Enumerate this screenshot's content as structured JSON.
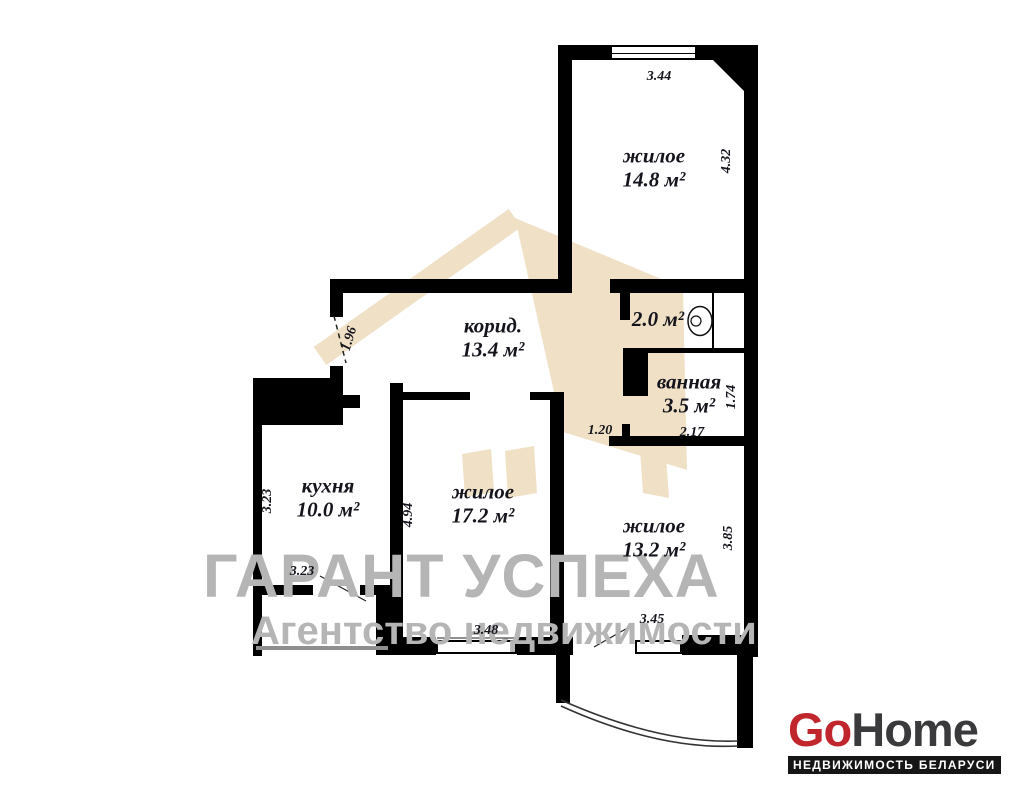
{
  "palette": {
    "wall": "#000000",
    "background": "#ffffff",
    "label_text": "#14141c",
    "watermark_gray": "#b5b5b5",
    "watermark_beige": "#f0e0c6",
    "logo_red": "#c2262d",
    "logo_dark": "#3a3a3c",
    "railing_gray": "#8f8f8f"
  },
  "watermark": {
    "title": "ГАРАНТ УСПЕХА",
    "subtitle": "Агентство недвижимости"
  },
  "logo": {
    "brand_red": "Go",
    "brand_dark": "Home",
    "tagline": "НЕДВИЖИМОСТЬ БЕЛАРУСИ"
  },
  "rooms": [
    {
      "id": "living-top",
      "name": "жилое",
      "area": "14.8 м²",
      "cx": 654,
      "cy": 168
    },
    {
      "id": "wc",
      "name": "",
      "area": "2.0 м²",
      "cx": 658,
      "cy": 320
    },
    {
      "id": "bathroom",
      "name": "ванная",
      "area": "3.5 м²",
      "cx": 689,
      "cy": 394
    },
    {
      "id": "corridor",
      "name": "корид.",
      "area": "13.4 м²",
      "cx": 493,
      "cy": 338
    },
    {
      "id": "kitchen",
      "name": "кухня",
      "area": "10.0 м²",
      "cx": 328,
      "cy": 498
    },
    {
      "id": "living-mid",
      "name": "жилое",
      "area": "17.2 м²",
      "cx": 483,
      "cy": 504
    },
    {
      "id": "living-right",
      "name": "жилое",
      "area": "13.2 м²",
      "cx": 654,
      "cy": 538
    }
  ],
  "dimensions": [
    {
      "value": "3.44",
      "x": 659,
      "y": 77,
      "rot": 0
    },
    {
      "value": "4.32",
      "x": 727,
      "y": 161,
      "rot": -90
    },
    {
      "value": "1.96",
      "x": 350,
      "y": 339,
      "rot": -73
    },
    {
      "value": "1.74",
      "x": 732,
      "y": 397,
      "rot": -90
    },
    {
      "value": "2.17",
      "x": 692,
      "y": 433,
      "rot": 0
    },
    {
      "value": "1.20",
      "x": 600,
      "y": 431,
      "rot": 0
    },
    {
      "value": "3.23",
      "x": 268,
      "y": 501,
      "rot": -90
    },
    {
      "value": "4.94",
      "x": 409,
      "y": 515,
      "rot": -90
    },
    {
      "value": "3.23",
      "x": 302,
      "y": 572,
      "rot": 0
    },
    {
      "value": "3.48",
      "x": 486,
      "y": 631,
      "rot": 0
    },
    {
      "value": "3.45",
      "x": 652,
      "y": 620,
      "rot": 0
    },
    {
      "value": "3.85",
      "x": 729,
      "y": 538,
      "rot": -90
    }
  ]
}
